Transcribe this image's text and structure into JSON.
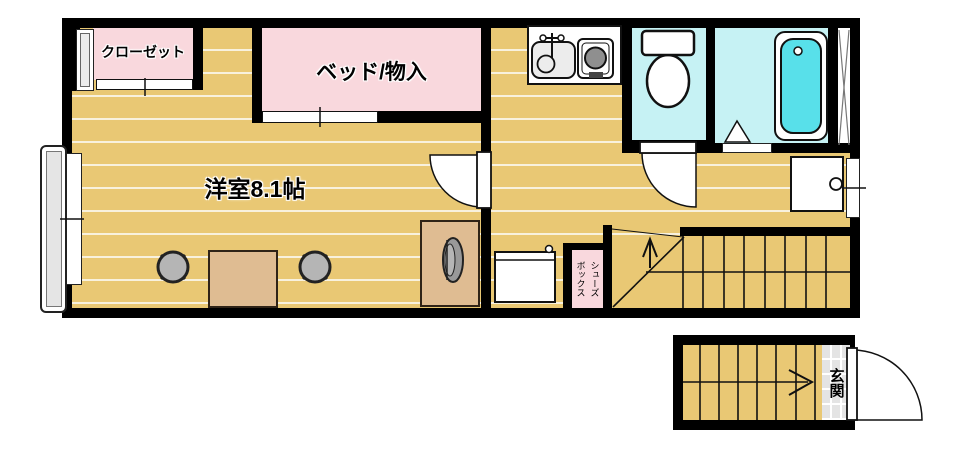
{
  "rooms": {
    "closet": {
      "label": "クローゼット"
    },
    "bed_storage": {
      "label": "ベッド/物入"
    },
    "western_room": {
      "label": "洋室8.1帖"
    },
    "shoe_box": {
      "label": "シューズ\nボックス"
    },
    "entrance": {
      "label": "玄関"
    }
  },
  "colors": {
    "wall": "#000000",
    "floor": "#e9c874",
    "floor_line": "#f8f1dd",
    "pink": "#f9d8dd",
    "cyan": "#c6f2f4",
    "tub": "#58e0ea",
    "furniture": "#dfbc92",
    "chair": "#b5b5b5",
    "tile": "#e4e4e4",
    "outline": "#111111"
  }
}
